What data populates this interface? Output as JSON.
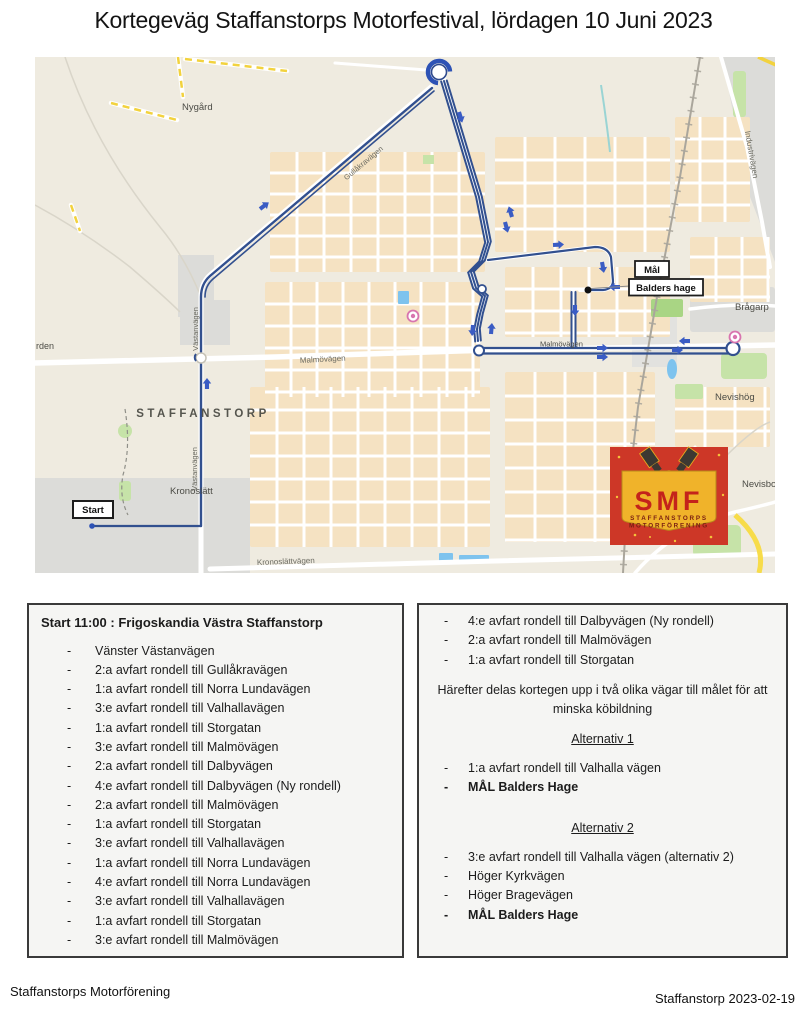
{
  "title": "Kortegeväg Staffanstorps Motorfestival, lördagen 10 Juni 2023",
  "map": {
    "labels": {
      "nygard": "Nygård",
      "rden": "rden",
      "staffanstorp": "STAFFANSTORP",
      "kronoslatt": "Kronoslätt",
      "kronoslattvagen": "Kronoslättvägen",
      "malmovagen_west": "Malmövägen",
      "malmovagen_route": "Malmövägen",
      "vastanvagen_north": "Västanvägen",
      "vastanvagen_south": "Västanvägen",
      "gullakravagen": "Gullåkravägen",
      "industrivagen": "Industrivägen",
      "bragarp": "Brågarp",
      "nevishog": "Nevishög",
      "nevisbo": "Nevisbo"
    },
    "markers": {
      "start": "Start",
      "mal": "Mål",
      "balders_hage": "Balders hage"
    },
    "logo": {
      "initials": "SMF",
      "line1": "STAFFANSTORPS",
      "line2": "MOTORFÖRENING",
      "bg_color": "#cd3727",
      "shield_color": "#f0b32a",
      "text_color": "#c4231b"
    },
    "colors": {
      "route": "#32508f",
      "arrow": "#3a5cc4",
      "land": "#efebe0",
      "blocks": "#f5e2c2",
      "water": "#7ec3ee",
      "green": "#c6e3a8",
      "industrial": "#dcdcd9"
    }
  },
  "left_panel": {
    "header": "Start 11:00 : Frigoskandia Västra Staffanstorp",
    "items": [
      "Vänster Västanvägen",
      "2:a avfart rondell till Gullåkravägen",
      "1:a avfart rondell till Norra Lundavägen",
      "3:e avfart rondell till Valhallavägen",
      "1:a avfart rondell till Storgatan",
      "3:e avfart rondell till Malmövägen",
      "2:a avfart rondell till Dalbyvägen",
      "4:e avfart rondell till Dalbyvägen (Ny rondell)",
      "2:a avfart rondell till Malmövägen",
      "1:a avfart rondell till Storgatan",
      "3:e avfart rondell till Valhallavägen",
      "1:a avfart rondell till Norra Lundavägen",
      "4:e avfart rondell till Norra Lundavägen",
      "3:e avfart rondell till Valhallavägen",
      "1:a avfart rondell till Storgatan",
      "3:e avfart rondell till Malmövägen"
    ]
  },
  "right_panel": {
    "items_top": [
      "4:e avfart rondell till Dalbyvägen (Ny rondell)",
      "2:a avfart rondell till Malmövägen",
      "1:a avfart rondell till Storgatan"
    ],
    "split_text": "Härefter delas kortegen upp i två olika vägar till målet för att minska köbildning",
    "alt1": {
      "title": "Alternativ 1",
      "items": [
        "1:a avfart rondell till Valhalla vägen",
        "MÅL Balders Hage"
      ]
    },
    "alt2": {
      "title": "Alternativ 2",
      "items": [
        "3:e avfart rondell till Valhalla vägen (alternativ 2)",
        "Höger Kyrkvägen",
        "Höger Bragevägen",
        "MÅL Balders Hage"
      ]
    }
  },
  "footer": {
    "left": "Staffanstorps Motorförening",
    "right": "Staffanstorp 2023-02-19"
  }
}
